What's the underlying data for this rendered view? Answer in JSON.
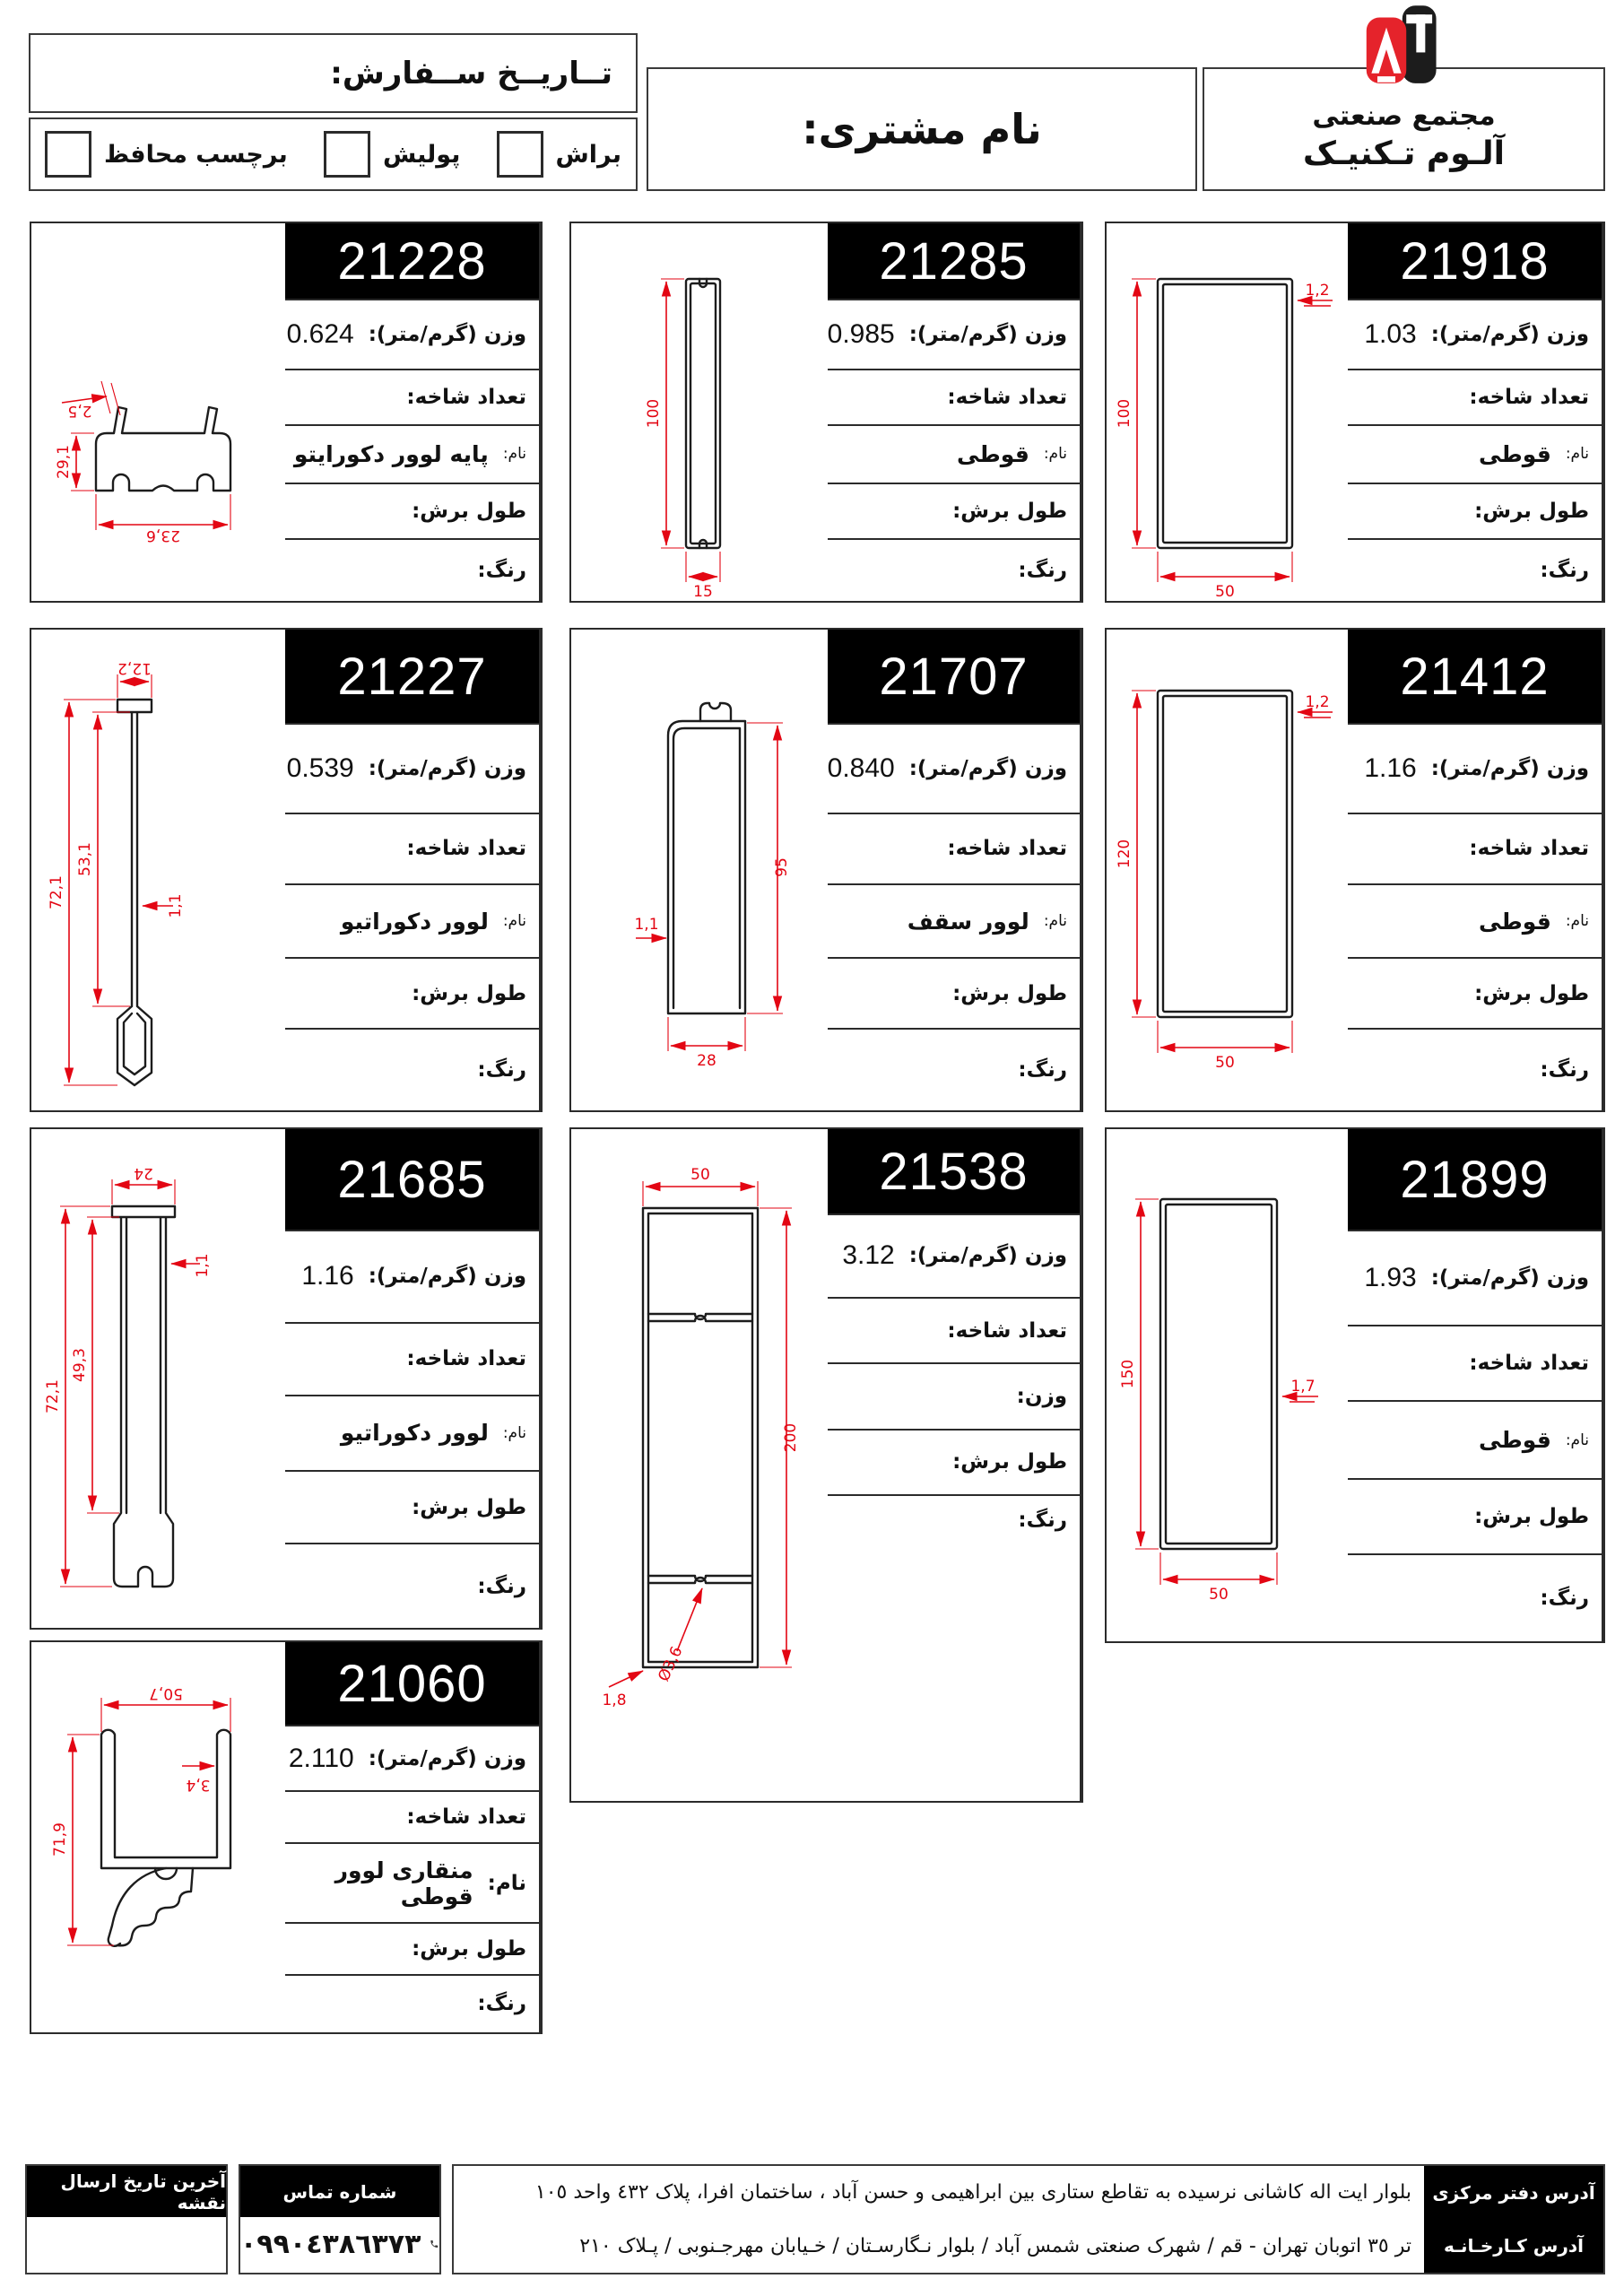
{
  "colors": {
    "accent_red": "#e30613",
    "logo_red": "#e5232b",
    "black": "#000000"
  },
  "header": {
    "logo": {
      "line1": "مجتمع صنعتی",
      "line2": "آلـوم تـکنیـک"
    },
    "customer_label": "نام مشتری:",
    "order_date_label": "تــاریــخ ســفارش:",
    "options": [
      {
        "label": "براش"
      },
      {
        "label": "پولیش"
      },
      {
        "label": "برچسب محافظ"
      }
    ]
  },
  "row_labels": {
    "weight": "وزن (گرم/متر):",
    "branches": "تعداد شاخه:",
    "name": "نام:",
    "weight2": "وزن:",
    "cut_length": "طول برش:",
    "color": "رنگ:"
  },
  "cards": [
    {
      "id": "21228",
      "weight": "0.624",
      "name": "پایه لوور دکورایتو",
      "dims": {
        "a": "2,5",
        "b": "29,1",
        "c": "23,6"
      }
    },
    {
      "id": "21285",
      "weight": "0.985",
      "name": "قوطی",
      "dims": {
        "a": "100",
        "b": "15"
      }
    },
    {
      "id": "21918",
      "weight": "1.03",
      "name": "قوطی",
      "dims": {
        "a": "100",
        "b": "1,2",
        "c": "50"
      }
    },
    {
      "id": "21227",
      "weight": "0.539",
      "name": "لوور دکوراتیو",
      "dims": {
        "a": "12,2",
        "b": "1,1",
        "c": "53,1",
        "d": "72,1"
      }
    },
    {
      "id": "21707",
      "weight": "0.840",
      "name": "لوور سقف",
      "dims": {
        "a": "95",
        "b": "1,1",
        "c": "28"
      }
    },
    {
      "id": "21412",
      "weight": "1.16",
      "name": "قوطی",
      "dims": {
        "a": "120",
        "b": "1,2",
        "c": "50"
      }
    },
    {
      "id": "21685",
      "weight": "1.16",
      "name": "لوور دکوراتیو",
      "dims": {
        "a": "24",
        "b": "1,1",
        "c": "49,3",
        "d": "72,1"
      }
    },
    {
      "id": "21538",
      "weight": "3.12",
      "dims": {
        "a": "50",
        "b": "200",
        "c": "Ø3,6",
        "d": "1,8"
      }
    },
    {
      "id": "21899",
      "weight": "1.93",
      "name": "قوطی",
      "dims": {
        "a": "150",
        "b": "1,7",
        "c": "50"
      }
    },
    {
      "id": "21060",
      "weight": "2.110",
      "name": "منقاری لوور قوطی",
      "dims": {
        "a": "50,7",
        "b": "3,4",
        "c": "71,9"
      }
    }
  ],
  "footer": {
    "map_box_label": "آخرین تاریخ ارسال نقشه",
    "phone_box_label": "شماره تماس",
    "phone_number": "۰۹۹۰٤۳۸٦۳۷۳",
    "address_labels": {
      "office": "آدرس دفتر مرکزی",
      "factory": "آدرس کـارخـانـه"
    },
    "addresses": {
      "office": "بلوار ایت اله کاشانی نرسیده به تقاطع ستاری بین ابراهیمی و حسن آباد ، ساختمان افرا، پلاک ٤٣٢ واحد ١٠٥",
      "factory": "تر ٣٥ اتوبان تهران - قم / شهرک صنعتی شمس آباد / بلوار نـگارسـتان / خـیابان مهرجـنوبی / پـلاک ٢١٠"
    }
  }
}
